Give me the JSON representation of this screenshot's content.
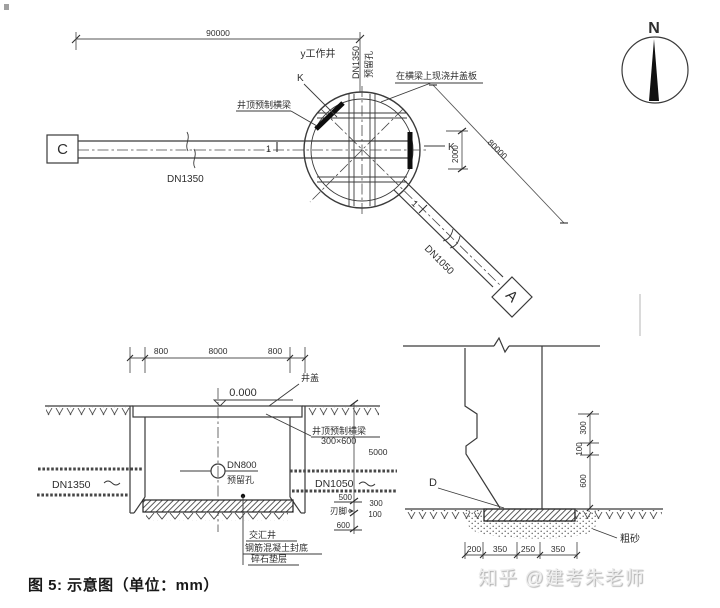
{
  "plan": {
    "dims": {
      "length_left": "90000",
      "length_right": "80000",
      "k_span": "2000"
    },
    "labels": {
      "work_well": "y工作井",
      "dn1350_top": "DN1350",
      "reserved_hole_top": "预留孔",
      "cast_cover": "在横梁上现浇井盖板",
      "precast_beam": "井顶预制横梁",
      "pipe_left": "DN1350",
      "pipe_right": "DN1050",
      "node_c": "C",
      "node_a": "A",
      "k_left": "K",
      "k_right": "K",
      "section_mark_left": "1",
      "section_mark_right": "1"
    },
    "north": {
      "label": "N"
    }
  },
  "section": {
    "dims": {
      "top_left": "800",
      "top_mid": "8000",
      "top_right": "800",
      "elevation": "0.000",
      "depth": "5000",
      "w500": "500",
      "w300": "300",
      "w100": "100",
      "w600": "600"
    },
    "labels": {
      "well_cover": "井盖",
      "beam": "井顶预制横梁",
      "beam_size": "300×600",
      "dn800": "DN800",
      "reserved_hole": "预留孔",
      "pipe_left": "DN1350",
      "pipe_right": "DN1050",
      "blade_foot": "刃脚",
      "junction_well": "交汇井",
      "concrete_seal": "钢筋混凝土封底",
      "gravel_cushion": "碎石垫层"
    }
  },
  "detail": {
    "dims": {
      "v300": "300",
      "v100": "100",
      "v600": "600",
      "h200": "200",
      "h350a": "350",
      "h250": "250",
      "h350b": "350"
    },
    "labels": {
      "d_mark": "D",
      "coarse_sand": "粗砂"
    }
  },
  "footer": {
    "caption": "图 5: 示意图（单位：mm）",
    "watermark": "知乎 @建考朱老师"
  },
  "colors": {
    "line": "#3a3a3a",
    "dim": "#555555",
    "fill_dark": "#111111",
    "watermark": "#ededed"
  }
}
